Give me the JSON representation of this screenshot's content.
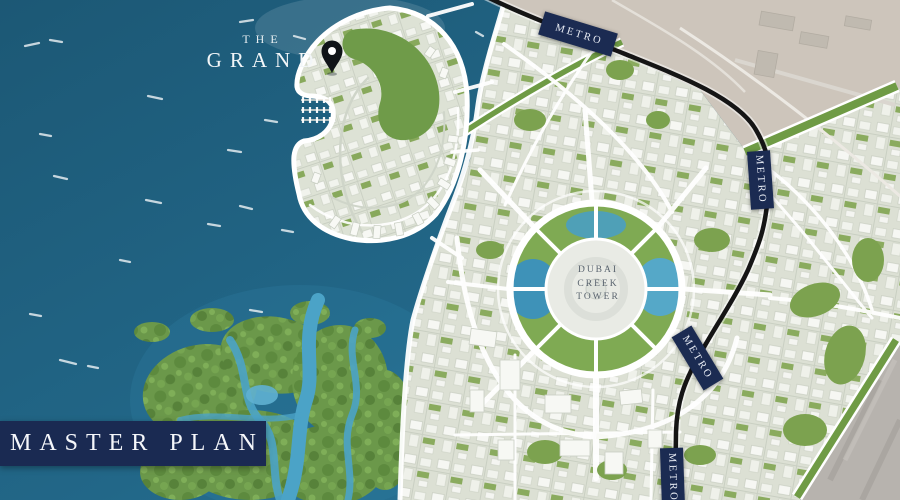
{
  "page": {
    "title": "Master Plan"
  },
  "banner": {
    "label": "MASTER PLAN"
  },
  "development": {
    "name_line1": "THE",
    "name_line2": "GRAND"
  },
  "landmark": {
    "line1": "DUBAI",
    "line2": "CREEK",
    "line3": "TOWER"
  },
  "metro": {
    "badges": [
      {
        "label": "METRO"
      },
      {
        "label": "METRO"
      },
      {
        "label": "METRO"
      },
      {
        "label": "METRO"
      }
    ]
  },
  "colors": {
    "navy": "#1a2a52",
    "sea_deep": "#1e5e7e",
    "sea_light": "#2b7a9d",
    "creek": "#2e81a3",
    "mangrove_channel": "#4ba3c7",
    "city_ground": "#dce0d4",
    "greenery": "#7ca24f",
    "sand": "#cdc5bb",
    "metro_line": "#151515",
    "road": "#ffffff"
  }
}
